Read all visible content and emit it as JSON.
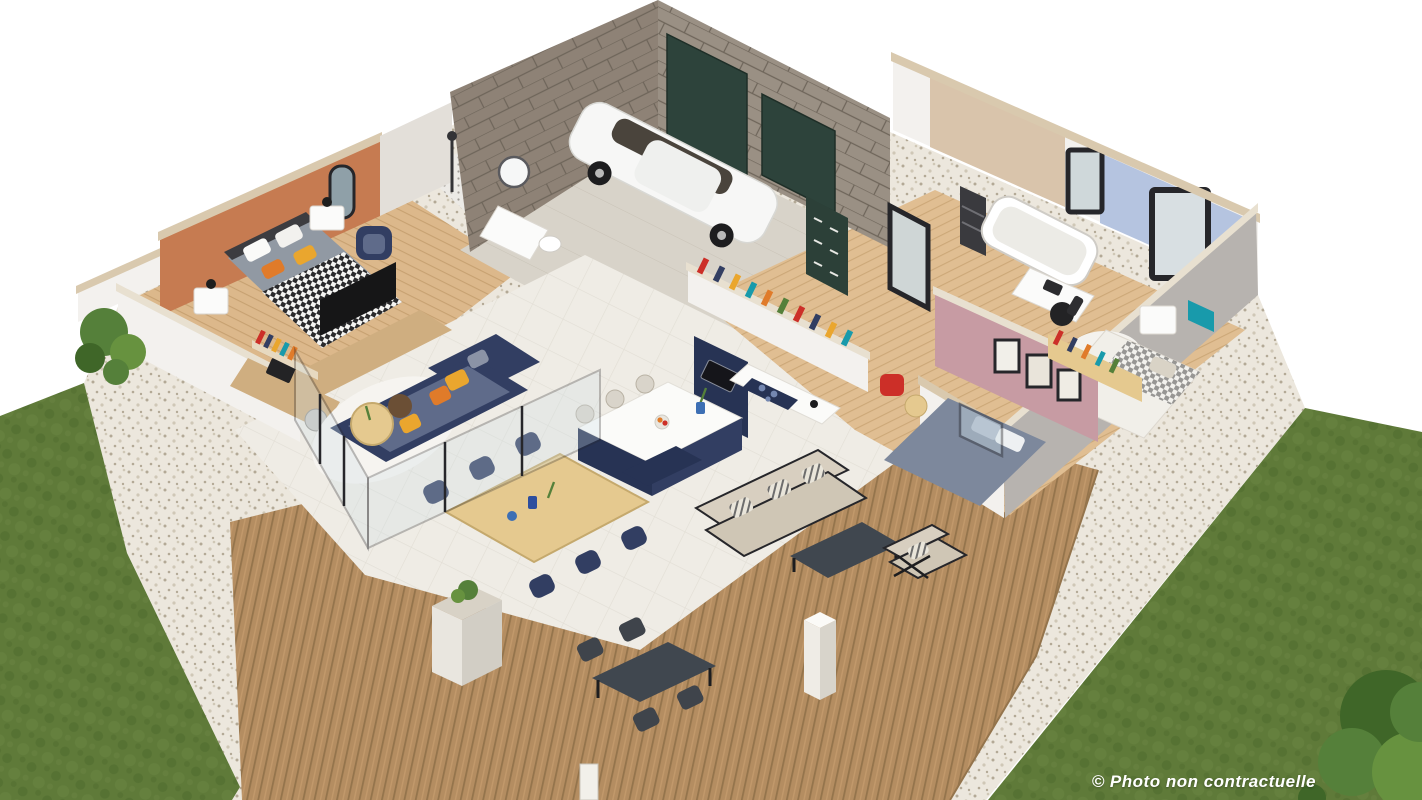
{
  "caption": {
    "text": "© Photo non contractuelle"
  },
  "scene": {
    "description": "Isometric 3D cutaway rendering of a single-storey house with garage, three bedrooms, bathroom, open living-kitchen, wooden terrace with outdoor furniture, gravel borders and lawns"
  },
  "colors": {
    "background": "#ffffff",
    "caption": "#ffffff",
    "lawn": "#5f7a39",
    "lawn_dark": "#4e6a2e",
    "lawn_light": "#6d8845",
    "gravel": "#ece7dd",
    "gravel_dot": "#b3a996",
    "gravel_dot2": "#cfc7b6",
    "deck": "#b48d61",
    "deck_dark": "#94744c",
    "deck_light": "#c59c6e",
    "wood_floor": "#dcb88b",
    "wood_line": "#c7a171",
    "wood_floor_r": "#e0be92",
    "wood_line_r": "#cca878",
    "tile": "#efece5",
    "tile_line": "#e2ded5",
    "concrete": "#d8d3c9",
    "concrete_line": "#c9c3b7",
    "mosaic": "#eceae6",
    "mosaic_dot": "#55504a",
    "wall_white": "#f3f1ee",
    "wall_shadow": "#e3dfd9",
    "wall_gray": "#b7b3af",
    "cap_beige": "#d9c9ae",
    "cap_light": "#e8e0d0",
    "brick": "#8e8276",
    "brick_line": "#6e655a",
    "brick2": "#9a9084",
    "garage_green": "#2d433b",
    "cabinet_green": "#2c4038",
    "orange_wall": "#c67b51",
    "blue_wall": "#b5c4e0",
    "pink_wall": "#c79ba3",
    "bath_tile": "#d9c4ab",
    "navy": "#323e62",
    "navy_dark": "#273354",
    "navy_seat": "#5f6b8a",
    "yellow": "#eaa62e",
    "orange": "#e07b2a",
    "bed_gray": "#9199a3",
    "bed_blue": "#7d889c",
    "bed_pillow": "#aab3c4",
    "outdoor_beige": "#cfc6b5",
    "outdoor_beige2": "#d8cfc0",
    "outdoor_dark": "#40474f",
    "frame_dark": "#26262a",
    "black": "#1d1d1f",
    "white": "#fafaf9",
    "teal": "#189aab",
    "red": "#cc2f28",
    "wood_mid": "#cfae80",
    "wood_table": "#e5c98f",
    "wood_table_line": "#c5a96d",
    "car_white": "#f7f7f6",
    "car_glass": "#4a443c",
    "green_dark": "#3f6628",
    "green_mid": "#55803a",
    "green_bush": "#67923f"
  }
}
